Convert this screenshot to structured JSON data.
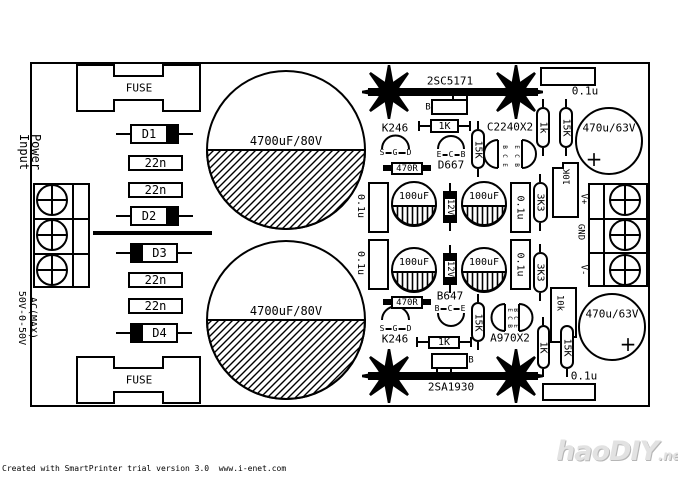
{
  "page": {
    "background": "#ffffff",
    "ink": "#000000"
  },
  "board": {
    "input": {
      "fuse_top": "FUSE",
      "fuse_bottom": "FUSE",
      "power_line1": "Power",
      "power_line2": "Input",
      "ac_line1": "AC(MAX)",
      "ac_line2": "50V-0-50V",
      "diodes": [
        "D1",
        "D2",
        "D3",
        "D4"
      ],
      "film_caps": [
        "22n",
        "22n",
        "22n",
        "22n"
      ],
      "bulk_caps": [
        "4700uF/80V",
        "4700uF/80V"
      ]
    },
    "positive_rail": {
      "power_transistor": "2SC5171",
      "base_pin": "B",
      "jfet": {
        "name": "K246",
        "pins": [
          "S",
          "G",
          "D"
        ]
      },
      "driver": {
        "name": "D667",
        "pins": [
          "E",
          "C",
          "B"
        ]
      },
      "dual": {
        "name": "C2240X2",
        "pins_left": [
          "B",
          "C",
          "E"
        ],
        "pins_right": [
          "E",
          "C",
          "B"
        ]
      },
      "r1k": "1K",
      "r470": "470R",
      "r15k": "15K",
      "caps_100uf": [
        "100uF",
        "100uF"
      ],
      "zener": "12V",
      "cap01_left": "0.1u",
      "cap01_right": "0.1u",
      "cap01_corner": "0.1u",
      "divider": [
        "1k",
        "15K"
      ],
      "r3k3": "3K3",
      "trimmer": "10K",
      "out_cap": "470u/63V",
      "polarity": "+"
    },
    "negative_rail": {
      "power_transistor": "2SA1930",
      "base_pin": "B",
      "jfet": {
        "name": "K246",
        "pins": [
          "S",
          "G",
          "D"
        ]
      },
      "driver": {
        "name": "B647",
        "pins": [
          "B",
          "C",
          "E"
        ]
      },
      "dual": {
        "name": "A970X2",
        "pins_left": [
          "E",
          "C",
          "B"
        ],
        "pins_right": [
          "B",
          "C",
          "E"
        ]
      },
      "r1k": "1K",
      "r470": "470R",
      "r15k": "15K",
      "caps_100uf": [
        "100uF",
        "100uF"
      ],
      "zener": "12V",
      "cap01_left": "0.1u",
      "cap01_right": "0.1u",
      "cap01_corner": "0.1u",
      "divider": [
        "1K",
        "15K"
      ],
      "r3k3": "3K3",
      "trimmer": "10k",
      "out_cap": "470u/63V",
      "polarity": "+"
    },
    "output": {
      "labels": [
        "V+",
        "GND",
        "V-"
      ]
    }
  },
  "footer": {
    "credit": "Created with SmartPrinter trial version 3.0  www.i-enet.com"
  },
  "watermark": {
    "brand": "haoDIY",
    "tld": ".net"
  }
}
